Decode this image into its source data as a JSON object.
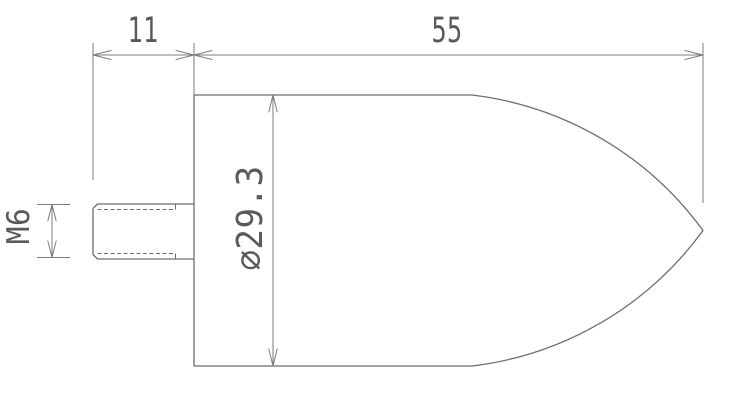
{
  "drawing": {
    "type": "technical-drawing",
    "part": "bullet-nose pin with threaded stud",
    "view": "side profile",
    "dimensions": {
      "stud_length": "11",
      "body_length": "55",
      "thread": "M6",
      "body_diameter": "⌀29.3"
    },
    "colors": {
      "background": "#ffffff",
      "object_line": "#6e6e6e",
      "dimension_line": "#7c7c7c",
      "text": "#5a5a5a"
    }
  }
}
